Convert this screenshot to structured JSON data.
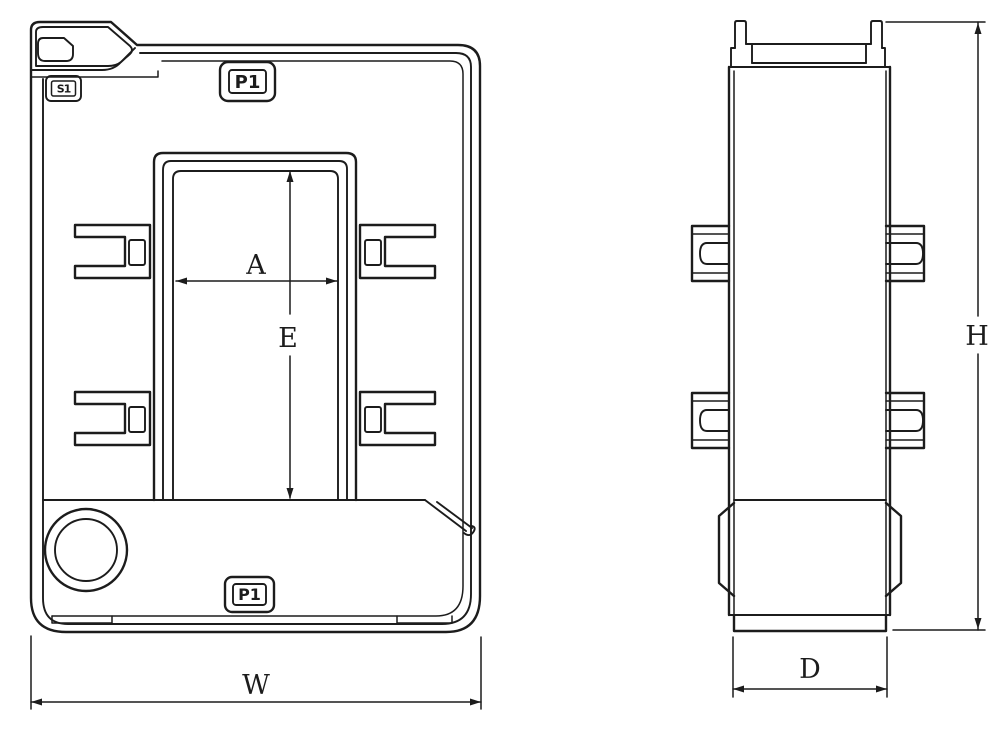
{
  "page": {
    "background": "#ffffff",
    "line_color": "#1c1c1c"
  },
  "front_view": {
    "terminals": {
      "s1": "S1",
      "p1_top": "P1",
      "p1_bottom": "P1"
    },
    "dimensions": {
      "window_width": "A",
      "window_height": "E",
      "overall_width": "W"
    }
  },
  "side_view": {
    "dimensions": {
      "overall_height": "H",
      "overall_depth": "D"
    }
  }
}
